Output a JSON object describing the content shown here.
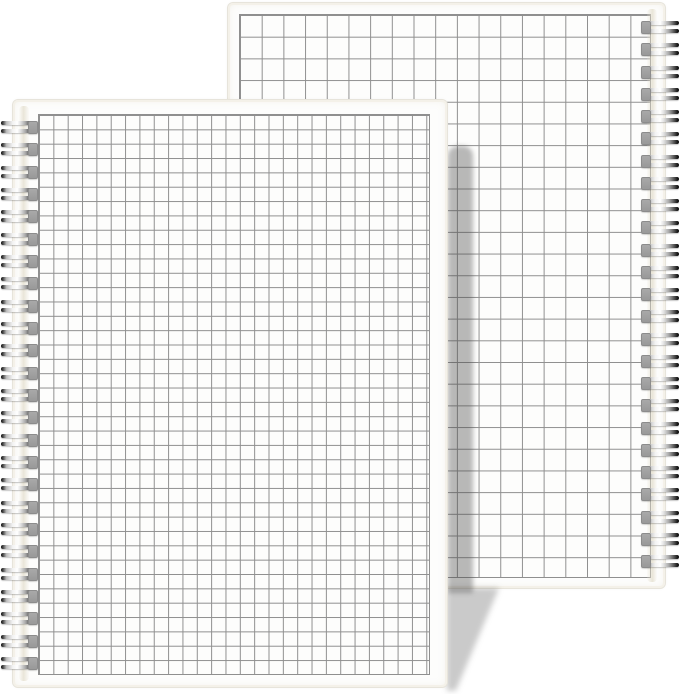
{
  "scene": {
    "type": "product-photo",
    "description": "Two white spiral-bound notebooks with square grid graph-paper covers, overlapping on a plain white background; no visible text",
    "background_color": "#ffffff"
  },
  "notebooks": [
    {
      "name": "back-notebook",
      "position": "upper-right, partly behind",
      "binding_side": "right",
      "cover_pattern": "square-grid",
      "ring_count": 25,
      "grid_cell_px": 21.7,
      "colors": {
        "paper": "#fdfdfc",
        "grid_line": "#8f8f8f",
        "page_edge": "#efe9db",
        "hole_tab": "#a9a9a9",
        "wire_dark": "#141414",
        "wire_light": "#ffffff"
      }
    },
    {
      "name": "front-notebook",
      "position": "lower-left, in front",
      "binding_side": "left",
      "cover_pattern": "square-grid",
      "ring_count": 25,
      "grid_cell_px": 14.35,
      "colors": {
        "paper": "#fdfdfc",
        "grid_line": "#8f8f8f",
        "page_edge": "#efe9db",
        "hole_tab": "#a9a9a9",
        "wire_dark": "#141414",
        "wire_light": "#ffffff"
      }
    }
  ],
  "shadow": {
    "description": "Shadow cast by the front notebook onto the back notebook cover and onto the background below it",
    "strip_color": "rgba(70,70,70,0.38)",
    "floor_color": "rgba(90,90,90,0.32)"
  }
}
